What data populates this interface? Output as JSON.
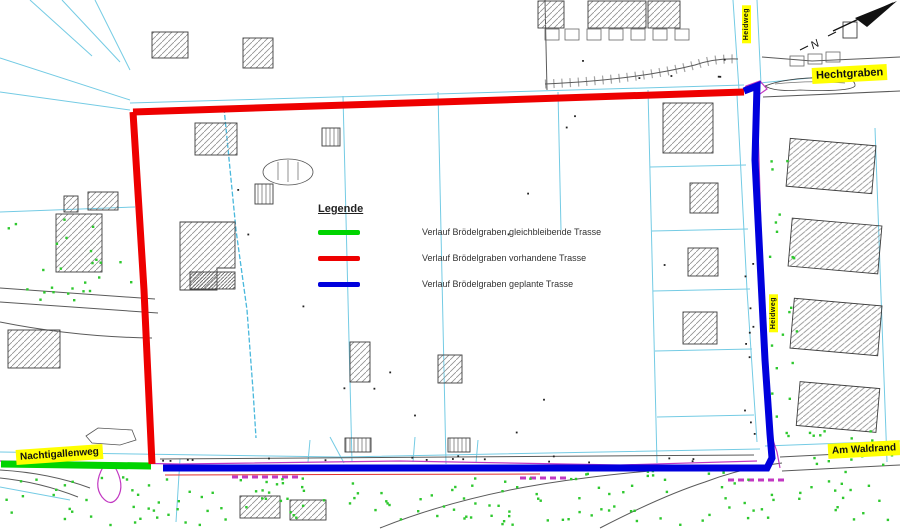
{
  "map": {
    "street_labels": {
      "hechtgraben": "Hechtgraben",
      "nachtigallenweg": "Nachtigallenweg",
      "am_waldrand": "Am Waldrand",
      "heidweg_top": "Heidweg",
      "heidweg_right": "Heidweg"
    },
    "north_arrow": "N"
  },
  "legend": {
    "title": "Legende",
    "items": [
      {
        "label": "Verlauf Brödelgraben gleichbleibende Trasse",
        "color": "#00d400"
      },
      {
        "label": "Verlauf Brödelgraben vorhandene Trasse",
        "color": "#ee0000"
      },
      {
        "label": "Verlauf Brödelgraben geplante Trasse",
        "color": "#0000dd"
      }
    ]
  },
  "colors": {
    "parcel_lines": "#74cbe4",
    "ditch_line": "#49b8dc",
    "road_lines": "#5a5a5a",
    "vegetation_dots": "#2ec82e",
    "utility_line": "#c238c2",
    "label_background": "#ffff00"
  }
}
